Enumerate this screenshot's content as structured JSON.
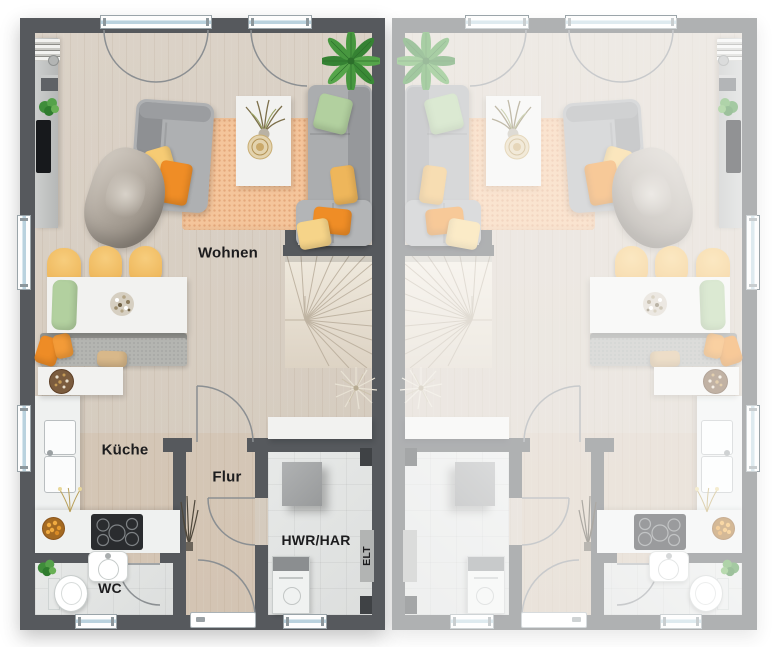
{
  "floorplan": {
    "rooms": {
      "living": "Wohnen",
      "kitchen": "Küche",
      "hallway": "Flur",
      "wc": "WC",
      "utility": "HWR/HAR",
      "electrical": "ELT"
    },
    "colors": {
      "wall": "#56595d",
      "wood_floor": "#d7cec3",
      "tile_floor": "#e2e4e3",
      "rug": "#f3c094",
      "accent_orange": "#ef8d26",
      "accent_yellow": "#f6cb74",
      "accent_green": "#b2d09f",
      "label_text": "#1c1c1e"
    }
  }
}
